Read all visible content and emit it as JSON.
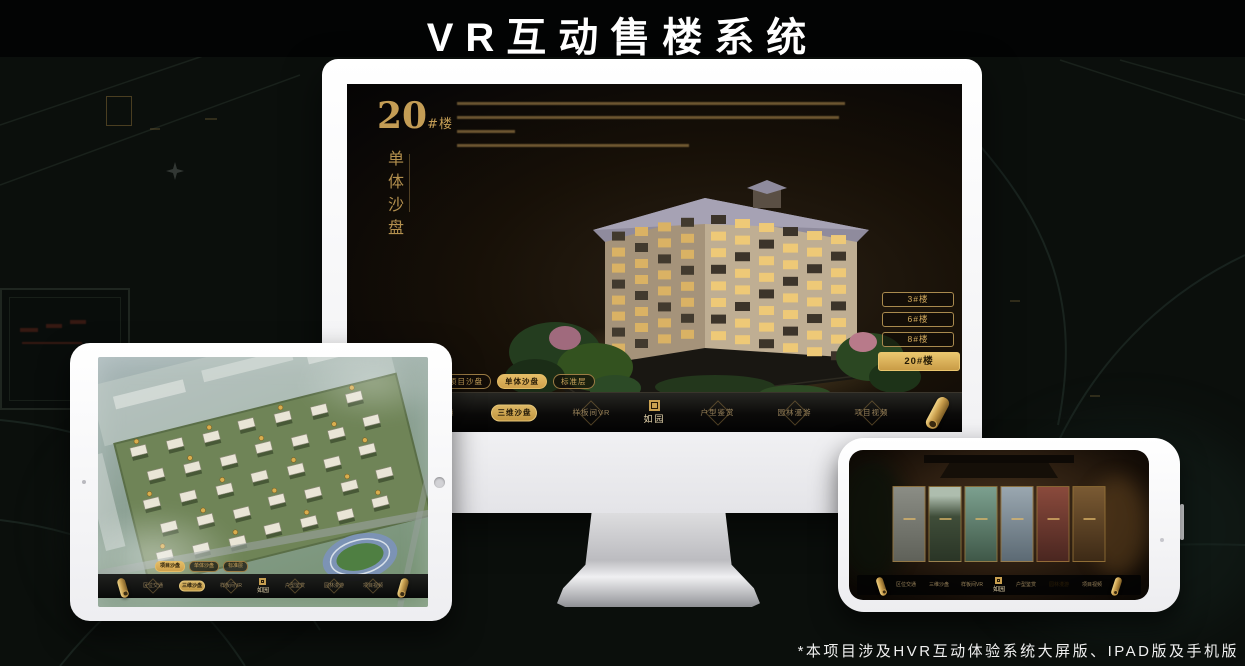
{
  "header": {
    "title": "VR互动售楼系统"
  },
  "footer": {
    "note": "*本项目涉及HVR互动体验系统大屏版、IPAD版及手机版"
  },
  "brand": {
    "logo": "如园"
  },
  "nav": {
    "items": [
      "区位交通",
      "三维沙盘",
      "样板间VR",
      "户型鉴赏",
      "园林漫游",
      "项目视频"
    ]
  },
  "sub_tabs": [
    "项目沙盘",
    "单体沙盘",
    "标准层"
  ],
  "monitor_screen": {
    "heading_number": "20",
    "heading_suffix": "#楼",
    "subtitle_vertical": "单体沙盘",
    "floor_buttons": [
      "3#楼",
      "6#楼",
      "8#楼",
      "20#楼"
    ],
    "active_floor": "20#楼",
    "active_sub_tab": "单体沙盘",
    "active_nav": "三维沙盘"
  },
  "tablet_screen": {
    "active_sub_tab": "项目沙盘",
    "active_nav": "三维沙盘"
  },
  "phone_screen": {
    "active_nav": "园林漫游"
  },
  "colors": {
    "gold": "#c9a258",
    "gold_active": "#d9ae5c",
    "background": "#0b0f0c",
    "bezel": "#ffffff"
  }
}
